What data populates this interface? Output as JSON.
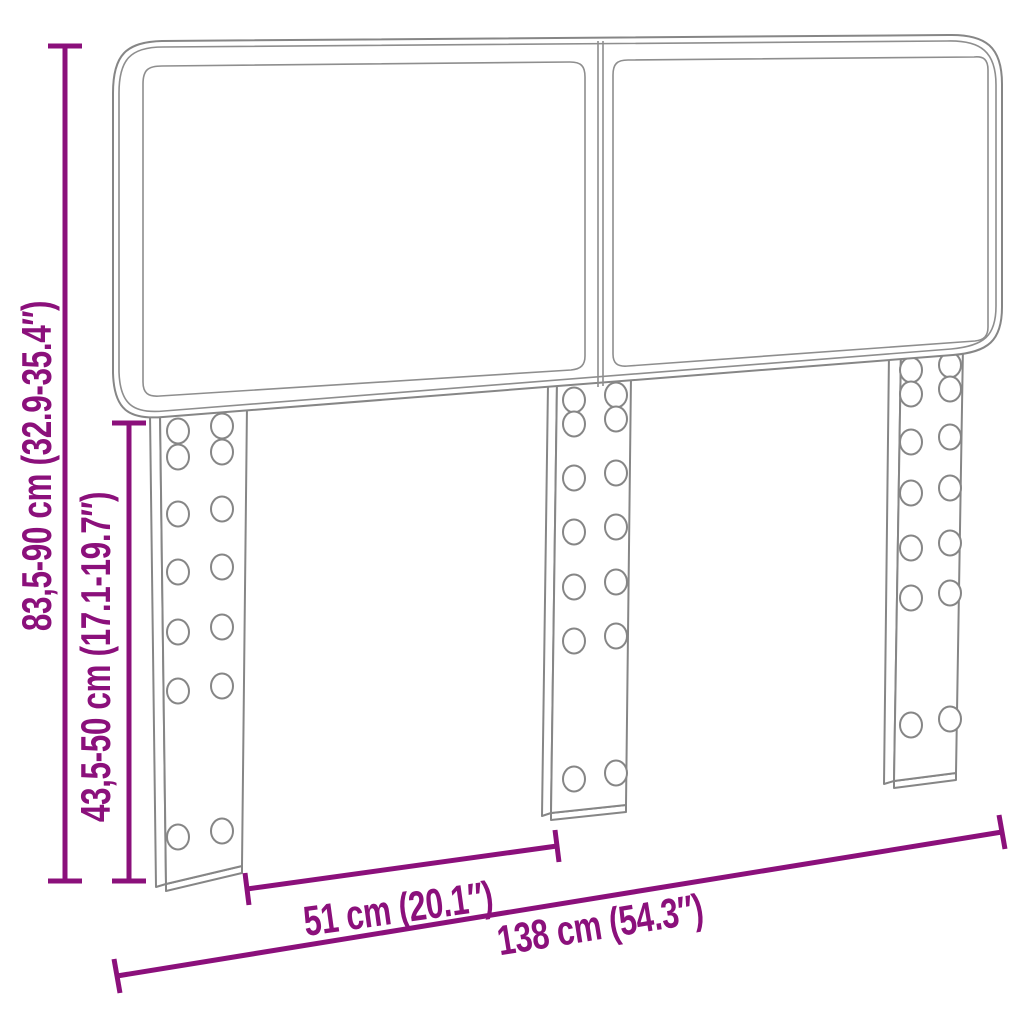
{
  "diagram": {
    "colors": {
      "dimension_accent": "#8B107B",
      "outline_gray": "#868686",
      "background": "#FFFFFF"
    },
    "dimension_labels": {
      "total_height": "83,5-90 cm (32.9-35.4″)",
      "leg_height": "43,5-50 cm (17.1-19.7″)",
      "leg_spacing": "51 cm (20.1″)",
      "total_width": "138 cm (54.3″)"
    }
  }
}
